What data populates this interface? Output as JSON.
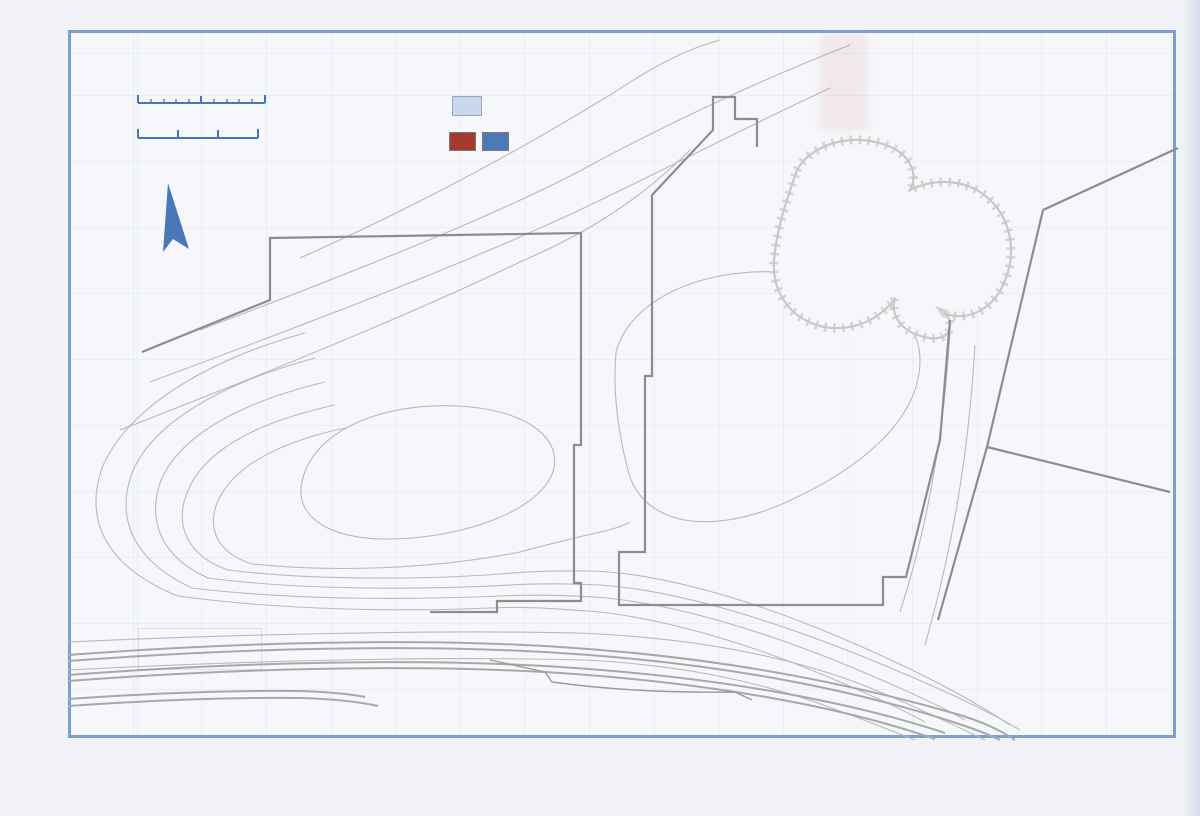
{
  "colors": {
    "frame_blue": "#7e9ecf",
    "label_blue": "#4a74b5",
    "key_blue": "#30599f",
    "loom_swatch_fill": "#cad8ed",
    "sfb_dark_red": "#9b2b20",
    "sfb_red": "#a84a3a",
    "sfb_salmon": "#c5837b",
    "sfb_blue": "#4a77b8",
    "feature_box_gray": "#8e8e8e",
    "contour_gray": "#b9b9b9",
    "boundary_gray": "#8d8d8d",
    "caption_dark": "#2b2b2b"
  },
  "captions": {
    "left": "Hall Group 3: B phase c.450-500AD",
    "right": "Hall Groups 2 and 5A: c.480-520AD"
  },
  "key": {
    "title": "Key",
    "loom_label": "Loom",
    "loom_symbol": "L",
    "sfb_label": "Dominant SFBs"
  },
  "scale_bar": {
    "feet_label": "100 feet",
    "metres_label": "30 metres"
  },
  "grid": {
    "columns": [
      "14",
      "13",
      "12",
      "11",
      "10",
      "9",
      "8",
      "7",
      "6",
      "5",
      "4",
      "3",
      "2",
      "1"
    ],
    "rows": [
      "WA",
      "WB",
      "WC",
      "WD",
      "WE",
      "WF",
      "WG",
      "WH"
    ]
  },
  "contour_labels": [
    {
      "t": "54",
      "x": 604,
      "y": 76,
      "r": -27
    },
    {
      "t": "56",
      "x": 608,
      "y": 136,
      "r": -25
    },
    {
      "t": "58",
      "x": 613,
      "y": 164,
      "r": -23
    },
    {
      "t": "60",
      "x": 621,
      "y": 224,
      "r": -40
    },
    {
      "t": "62",
      "x": 616,
      "y": 352,
      "r": -10
    },
    {
      "t": "64",
      "x": 492,
      "y": 404,
      "r": -4
    },
    {
      "t": "62",
      "x": 584,
      "y": 535,
      "r": -3
    },
    {
      "t": "60",
      "x": 592,
      "y": 571,
      "r": 0
    },
    {
      "t": "58",
      "x": 600,
      "y": 585,
      "r": 0
    },
    {
      "t": "56",
      "x": 595,
      "y": 597,
      "r": 0
    },
    {
      "t": "54",
      "x": 590,
      "y": 611,
      "r": 0
    },
    {
      "t": "52",
      "x": 579,
      "y": 633,
      "r": 0
    },
    {
      "t": "50",
      "x": 586,
      "y": 660,
      "r": 0
    }
  ],
  "features": [
    {
      "t": "31",
      "x": 761,
      "y": 144,
      "w": 26,
      "h": 17,
      "r": 0,
      "s": "plain"
    },
    {
      "t": "30",
      "x": 746,
      "y": 152,
      "w": 24,
      "h": 16,
      "r": 0,
      "s": "plain"
    },
    {
      "t": "35",
      "x": 664,
      "y": 188,
      "w": 23,
      "h": 17,
      "r": 0,
      "s": "plain"
    },
    {
      "t": "34",
      "x": 685,
      "y": 186,
      "w": 23,
      "h": 17,
      "r": 0,
      "s": "plain"
    },
    {
      "t": "40",
      "x": 677,
      "y": 209,
      "w": 26,
      "h": 17,
      "r": 0,
      "s": "plain"
    },
    {
      "t": "3",
      "x": 696,
      "y": 252,
      "w": 26,
      "h": 16,
      "r": -12,
      "s": "plain"
    },
    {
      "t": "1",
      "x": 737,
      "y": 262,
      "w": 26,
      "h": 18,
      "r": 0,
      "s": "plain"
    },
    {
      "t": "2",
      "x": 737,
      "y": 299,
      "w": 23,
      "h": 15,
      "r": -5,
      "s": "plain"
    },
    {
      "t": "15",
      "x": 790,
      "y": 293,
      "w": 26,
      "h": 16,
      "r": -8,
      "s": "plain"
    },
    {
      "t": "16",
      "x": 880,
      "y": 324,
      "w": 25,
      "h": 18,
      "r": 0,
      "s": "plain"
    },
    {
      "t": "17",
      "x": 936,
      "y": 356,
      "w": 26,
      "h": 17,
      "r": -15,
      "s": "plain"
    },
    {
      "t": "41",
      "x": 933,
      "y": 410,
      "w": 26,
      "h": 16,
      "r": -15,
      "s": "plain"
    },
    {
      "t": "14",
      "x": 1155,
      "y": 344,
      "w": 24,
      "h": 16,
      "r": 0,
      "s": "plain"
    },
    {
      "t": "48",
      "x": 513,
      "y": 360,
      "w": 26,
      "h": 16,
      "r": 0,
      "s": "plain"
    },
    {
      "t": "51",
      "x": 546,
      "y": 367,
      "w": 25,
      "h": 16,
      "r": 0,
      "s": "plain"
    },
    {
      "t": "50",
      "x": 560,
      "y": 384,
      "w": 26,
      "h": 17,
      "r": -20,
      "s": "plain"
    },
    {
      "t": "52",
      "x": 417,
      "y": 395,
      "w": 26,
      "h": 17,
      "r": -8,
      "s": "plain"
    },
    {
      "t": "54",
      "x": 430,
      "y": 419,
      "w": 26,
      "h": 15,
      "r": -12,
      "s": "plain"
    },
    {
      "t": "53",
      "x": 437,
      "y": 447,
      "w": 26,
      "h": 16,
      "r": -12,
      "s": "plain"
    },
    {
      "t": "36",
      "x": 533,
      "y": 452,
      "w": 23,
      "h": 17,
      "r": 0,
      "s": "plain"
    },
    {
      "t": "47",
      "x": 477,
      "y": 480,
      "w": 26,
      "h": 16,
      "r": -15,
      "s": "plain"
    },
    {
      "t": "37",
      "x": 504,
      "y": 508,
      "w": 21,
      "h": 17,
      "r": 0,
      "s": "plain"
    },
    {
      "t": "46",
      "x": 500,
      "y": 530,
      "w": 26,
      "h": 15,
      "r": 0,
      "s": "plain"
    },
    {
      "t": "9",
      "x": 688,
      "y": 412,
      "w": 21,
      "h": 14,
      "r": -8,
      "s": "plain"
    },
    {
      "t": "8",
      "x": 699,
      "y": 424,
      "w": 27,
      "h": 19,
      "r": -34,
      "s": "plain"
    },
    {
      "t": "11",
      "x": 746,
      "y": 419,
      "w": 26,
      "h": 17,
      "r": -18,
      "s": "plain"
    },
    {
      "t": "26",
      "x": 637,
      "y": 485,
      "w": 22,
      "h": 16,
      "r": -8,
      "s": "plain"
    },
    {
      "t": "25",
      "x": 652,
      "y": 497,
      "w": 24,
      "h": 15,
      "r": -5,
      "s": "plain"
    },
    {
      "t": "22",
      "x": 694,
      "y": 507,
      "w": 24,
      "h": 16,
      "r": -5,
      "s": "plain"
    },
    {
      "t": "28",
      "x": 806,
      "y": 490,
      "w": 21,
      "h": 15,
      "r": -10,
      "s": "plain"
    },
    {
      "t": "18",
      "x": 827,
      "y": 485,
      "w": 26,
      "h": 16,
      "r": -8,
      "s": "plain"
    },
    {
      "t": "21",
      "x": 746,
      "y": 528,
      "w": 25,
      "h": 17,
      "r": 0,
      "s": "plain"
    },
    {
      "t": "44",
      "x": 790,
      "y": 522,
      "w": 30,
      "h": 17,
      "r": -6,
      "s": "plain"
    },
    {
      "t": "19",
      "x": 728,
      "y": 550,
      "w": 24,
      "h": 15,
      "r": -5,
      "s": "plain"
    },
    {
      "t": "20",
      "x": 712,
      "y": 558,
      "w": 24,
      "h": 15,
      "r": 0,
      "s": "plain"
    },
    {
      "t": "45",
      "x": 822,
      "y": 546,
      "w": 26,
      "h": 16,
      "r": -12,
      "s": "plain"
    },
    {
      "t": "49",
      "x": 791,
      "y": 571,
      "w": 26,
      "h": 15,
      "r": 0,
      "s": "plain"
    },
    {
      "t": "57",
      "x": 280,
      "y": 491,
      "w": 26,
      "h": 15,
      "r": -10,
      "s": "plain"
    },
    {
      "t": "68",
      "x": 163,
      "y": 482,
      "w": 26,
      "h": 15,
      "r": -20,
      "s": "plain"
    },
    {
      "t": "67",
      "x": 204,
      "y": 523,
      "w": 24,
      "h": 15,
      "r": -38,
      "s": "plain"
    },
    {
      "t": "65",
      "x": 228,
      "y": 546,
      "w": 24,
      "h": 15,
      "r": 0,
      "s": "plain"
    },
    {
      "t": "69",
      "x": 184,
      "y": 552,
      "w": 26,
      "h": 16,
      "r": 0,
      "s": "plain"
    },
    {
      "t": "66",
      "x": 247,
      "y": 565,
      "w": 19,
      "h": 14,
      "r": 0,
      "s": "plain"
    },
    {
      "t": "61",
      "x": 288,
      "y": 566,
      "w": 24,
      "h": 14,
      "r": 0,
      "s": "plain"
    },
    {
      "t": "59",
      "x": 341,
      "y": 572,
      "w": 26,
      "h": 15,
      "r": -15,
      "s": "plain"
    },
    {
      "t": "56",
      "x": 378,
      "y": 575,
      "w": 23,
      "h": 14,
      "r": 0,
      "s": "plain"
    },
    {
      "t": "58",
      "x": 409,
      "y": 578,
      "w": 21,
      "h": 13,
      "r": 0,
      "s": "plain"
    },
    {
      "t": "55",
      "x": 417,
      "y": 556,
      "w": 26,
      "h": 14,
      "r": -8,
      "s": "plain"
    },
    {
      "t": "62",
      "x": 453,
      "y": 556,
      "w": 23,
      "h": 14,
      "r": -25,
      "s": "plain"
    },
    {
      "t": "60",
      "x": 441,
      "y": 568,
      "w": 23,
      "h": 14,
      "r": -30,
      "s": "plain"
    },
    {
      "t": "38",
      "x": 531,
      "y": 565,
      "w": 21,
      "h": 14,
      "r": 0,
      "s": "plain"
    },
    {
      "t": "10",
      "x": 1087,
      "y": 478,
      "w": 24,
      "h": 15,
      "r": -3,
      "s": "plain"
    },
    {
      "t": "43",
      "x": 876,
      "y": 197,
      "w": 26,
      "h": 17,
      "r": -40,
      "s": "dashed"
    },
    {
      "t": "31",
      "x": 930,
      "y": 237,
      "w": 25,
      "h": 16,
      "r": -10,
      "s": "dashed"
    },
    {
      "t": "32",
      "x": 948,
      "y": 262,
      "w": 25,
      "h": 16,
      "r": -8,
      "s": "dashed"
    },
    {
      "t": "33",
      "x": 966,
      "y": 289,
      "w": 25,
      "h": 16,
      "r": -12,
      "s": "dashed"
    },
    {
      "t": "H7 (1)",
      "x": 762,
      "y": 192,
      "w": 46,
      "h": 46,
      "r": 45,
      "s": "hall_diamond"
    },
    {
      "t": "H1",
      "x": 877,
      "y": 362,
      "w": 40,
      "h": 26,
      "r": 0,
      "s": "hall"
    },
    {
      "t": "H4",
      "x": 348,
      "y": 517,
      "w": 44,
      "h": 25,
      "r": -5,
      "s": "hall"
    },
    {
      "t": "H6",
      "x": 283,
      "y": 542,
      "w": 42,
      "h": 23,
      "r": -10,
      "s": "hall"
    },
    {
      "t": "H5",
      "x": 800,
      "y": 590,
      "w": 34,
      "h": 24,
      "r": 0,
      "s": "hall"
    },
    {
      "t": "H3",
      "x": 523,
      "y": 481,
      "w": 45,
      "h": 28,
      "r": -20,
      "s": "hall_blue"
    },
    {
      "t": "H2",
      "x": 652,
      "y": 457,
      "w": 44,
      "h": 27,
      "r": 0,
      "s": "hall_red"
    },
    {
      "t": "5",
      "x": 690,
      "y": 383,
      "w": 28,
      "h": 18,
      "r": -5,
      "s": "salmon"
    },
    {
      "t": "6",
      "x": 700,
      "y": 405,
      "w": 28,
      "h": 18,
      "r": -8,
      "s": "salmon"
    },
    {
      "t": "13",
      "x": 767,
      "y": 421,
      "w": 28,
      "h": 18,
      "r": -12,
      "s": "salmon"
    },
    {
      "t": "29",
      "x": 804,
      "y": 473,
      "w": 26,
      "h": 16,
      "r": -8,
      "s": "salmon"
    },
    {
      "t": "27",
      "x": 652,
      "y": 478,
      "w": 26,
      "h": 16,
      "r": -5,
      "s": "salmon_dark"
    },
    {
      "t": "24",
      "x": 668,
      "y": 505,
      "w": 26,
      "h": 16,
      "r": -8,
      "s": "salmon_dark"
    },
    {
      "t": "7",
      "x": 682,
      "y": 429,
      "w": 28,
      "h": 18,
      "r": -10,
      "s": "red"
    },
    {
      "t": "12",
      "x": 780,
      "y": 394,
      "w": 30,
      "h": 19,
      "r": -8,
      "s": "dark_red"
    },
    {
      "t": "5A",
      "x": 769,
      "y": 589,
      "w": 34,
      "h": 23,
      "r": 0,
      "s": "red_5a"
    },
    {
      "t": "39",
      "x": 559,
      "y": 455,
      "w": 30,
      "h": 17,
      "r": -25,
      "s": "blue"
    },
    {
      "t": "63",
      "x": 229,
      "y": 500,
      "w": 26,
      "h": 21,
      "r": 0,
      "s": "blue"
    },
    {
      "t": "42",
      "x": 548,
      "y": 574,
      "w": 32,
      "h": 17,
      "r": -5,
      "s": "blue"
    },
    {
      "t": "64",
      "x": 261,
      "y": 572,
      "w": 30,
      "h": 21,
      "r": 0,
      "s": "blue_white"
    }
  ],
  "loom_markers": [
    {
      "x": 757,
      "y": 388,
      "r": -5
    }
  ],
  "annotations": [
    {
      "text": "Ditch",
      "x": 666,
      "y": 681,
      "r": -3
    },
    {
      "text": "Filter Beds",
      "x": 1018,
      "y": 652,
      "r": -9
    }
  ],
  "ghost_text": [
    {
      "text": "Dominant SFBs",
      "x": 330,
      "y": 630
    },
    {
      "text": "Key",
      "x": 333,
      "y": 690
    }
  ]
}
